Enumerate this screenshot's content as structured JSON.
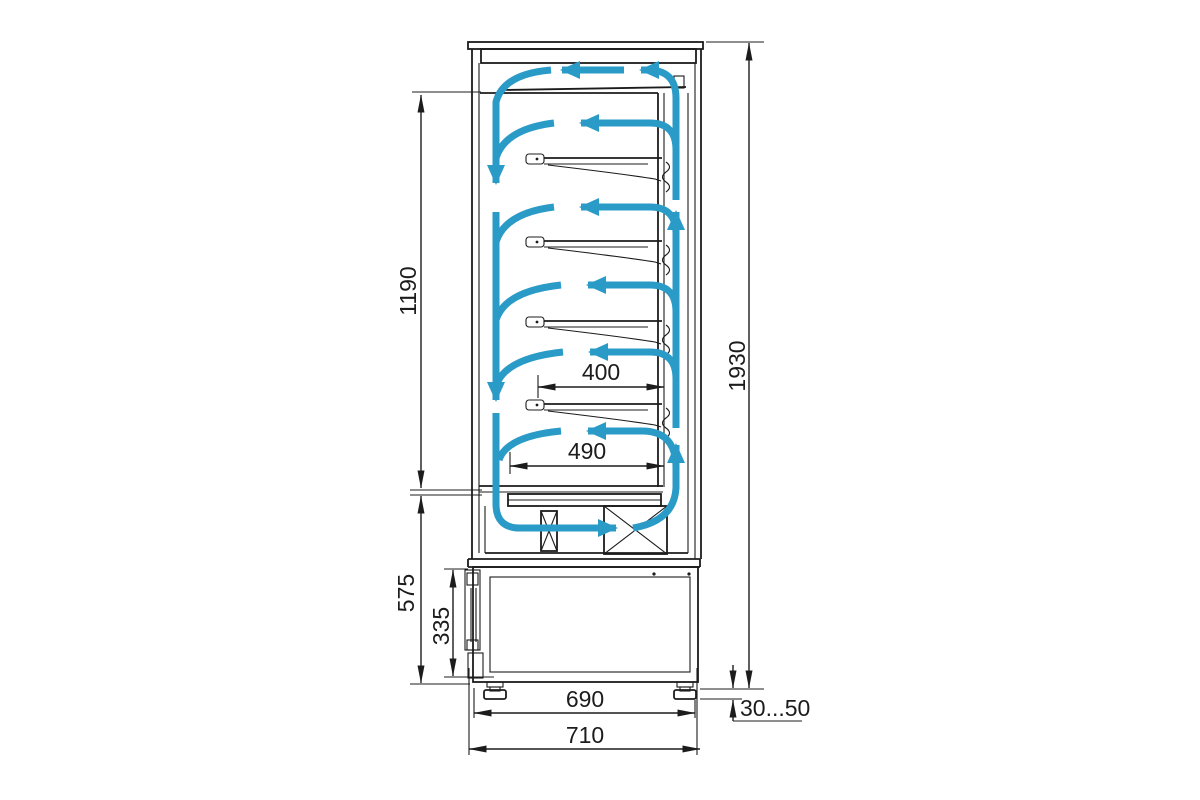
{
  "colors": {
    "line": "#1c1c1c",
    "airflow": "#2a9bc7",
    "background": "#ffffff"
  },
  "dimension_labels": {
    "opening_height": "1190",
    "overall_height": "1930",
    "base_section_height": "575",
    "machine_compartment_height": "335",
    "shelf_depth": "400",
    "bottom_deck_depth": "490",
    "feet_spacing": "690",
    "overall_depth": "710",
    "foot_adjustment": "30...50"
  }
}
